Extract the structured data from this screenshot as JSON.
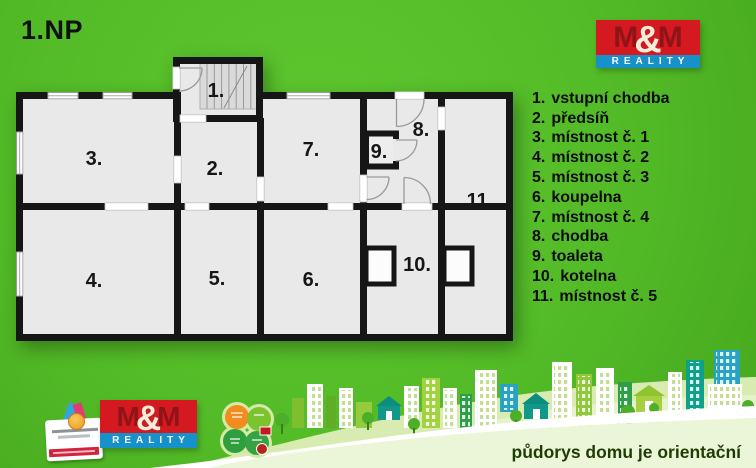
{
  "title": "1.NP",
  "logo": {
    "m_left": "M",
    "ampersand": "&",
    "m_right": "M",
    "reality": "REALITY"
  },
  "rooms": [
    {
      "num": "1.",
      "label": "vstupní chodba"
    },
    {
      "num": "2.",
      "label": "předsíň"
    },
    {
      "num": "3.",
      "label": "místnost č. 1"
    },
    {
      "num": "4.",
      "label": "místnost č. 2"
    },
    {
      "num": "5.",
      "label": "místnost č. 3"
    },
    {
      "num": "6.",
      "label": "koupelna"
    },
    {
      "num": "7.",
      "label": "místnost č. 4"
    },
    {
      "num": "8.",
      "label": "chodba"
    },
    {
      "num": "9.",
      "label": "toaleta"
    },
    {
      "num": "10.",
      "label": "kotelna"
    },
    {
      "num": "11.",
      "label": "místnost č. 5"
    }
  ],
  "footer": {
    "disclaimer": "půdorys domu je orientační"
  },
  "colors": {
    "background_green": "#53bb27",
    "plan_room_fill": "#e9e9e9",
    "plan_wall": "#161616",
    "logo_red": "#d41920",
    "logo_dark_red": "#8e1418",
    "logo_blue": "#1691c9",
    "disclaimer_text": "#1e3c05"
  }
}
